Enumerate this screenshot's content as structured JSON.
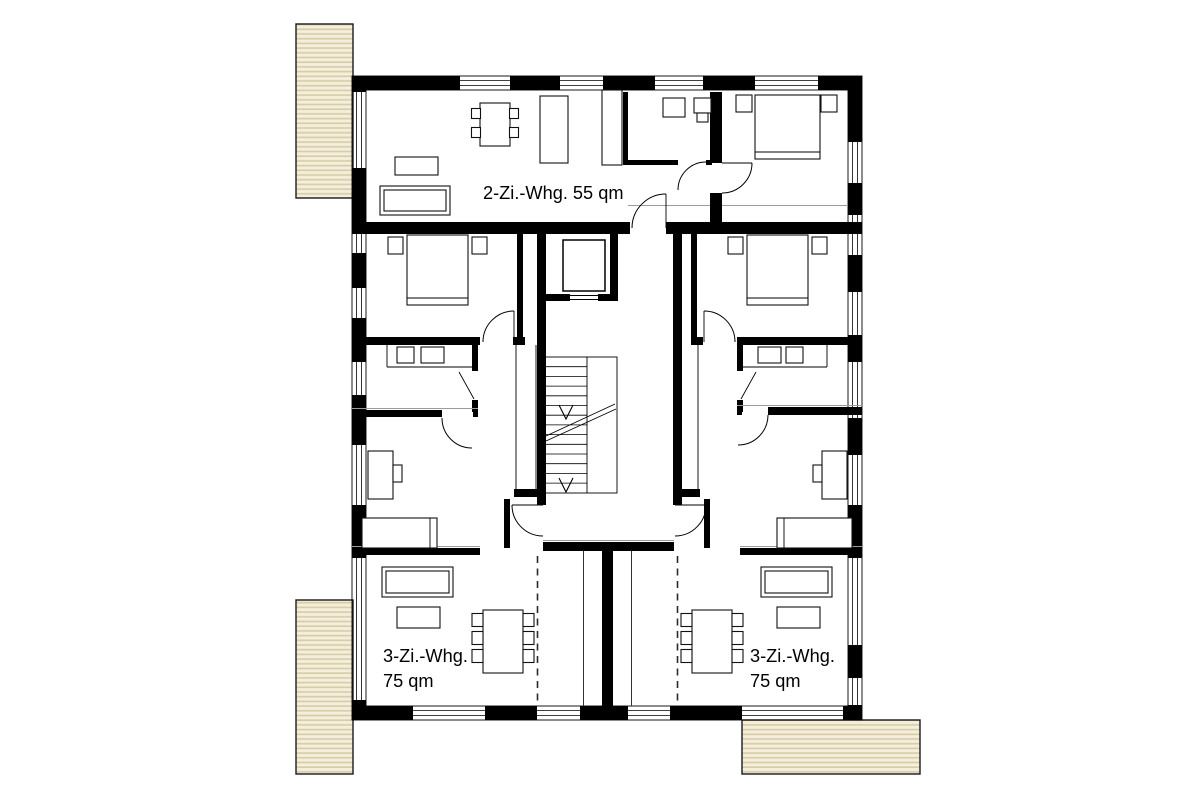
{
  "labels": {
    "apartment_top": "2-Zi.-Whg. 55 qm",
    "apartment_bottom_left_line1": "3-Zi.-Whg.",
    "apartment_bottom_left_line2": "75 qm",
    "apartment_bottom_right_line1": "3-Zi.-Whg.",
    "apartment_bottom_right_line2": "75 qm"
  },
  "colors": {
    "wall": "#000000",
    "balcony_fill": "#f4eedc",
    "balcony_stripe": "#d9cda8",
    "balcony_border": "#1a1a1a",
    "detail_gray": "#9b9b9b"
  }
}
